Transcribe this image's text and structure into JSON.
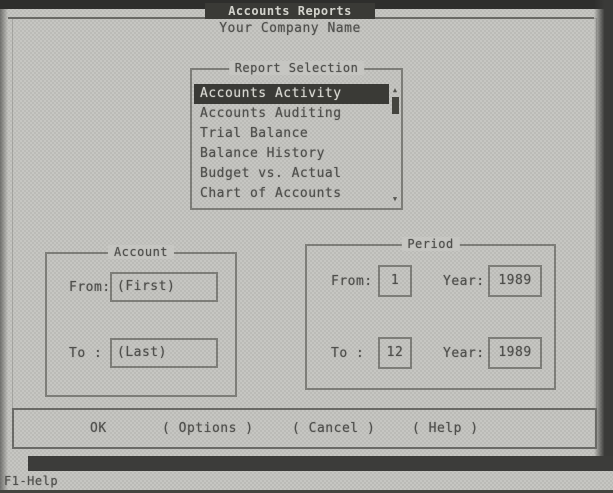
{
  "window": {
    "title": "Accounts Reports",
    "subtitle": "Your Company Name"
  },
  "report_selection": {
    "title": "Report Selection",
    "items": [
      "Accounts Activity",
      "Accounts Auditing",
      "Trial Balance",
      "Balance History",
      "Budget vs. Actual",
      "Chart of Accounts"
    ],
    "selected_index": 0,
    "scroll_up_icon": "▲",
    "scroll_down_icon": "▼"
  },
  "account": {
    "title": "Account",
    "from_label": "From:",
    "from_value": "(First)",
    "to_label": "To :",
    "to_value": "(Last)"
  },
  "period": {
    "title": "Period",
    "from_label": "From:",
    "from_value": "1",
    "from_year_label": "Year:",
    "from_year_value": "1989",
    "to_label": "To :",
    "to_value": "12",
    "to_year_label": "Year:",
    "to_year_value": "1989"
  },
  "buttons": {
    "ok": "OK",
    "options": "( Options )",
    "cancel": "( Cancel )",
    "help": "( Help )"
  },
  "status_bar": {
    "help_hint": "F1-Help"
  },
  "colors": {
    "paper": "#c6c6c2",
    "ink": "#4f4f4c",
    "border": "#7d7d78",
    "highlight_bg": "#3a3a36",
    "highlight_fg": "#d8d8d2",
    "edge_dark": "#2e2e2c"
  }
}
